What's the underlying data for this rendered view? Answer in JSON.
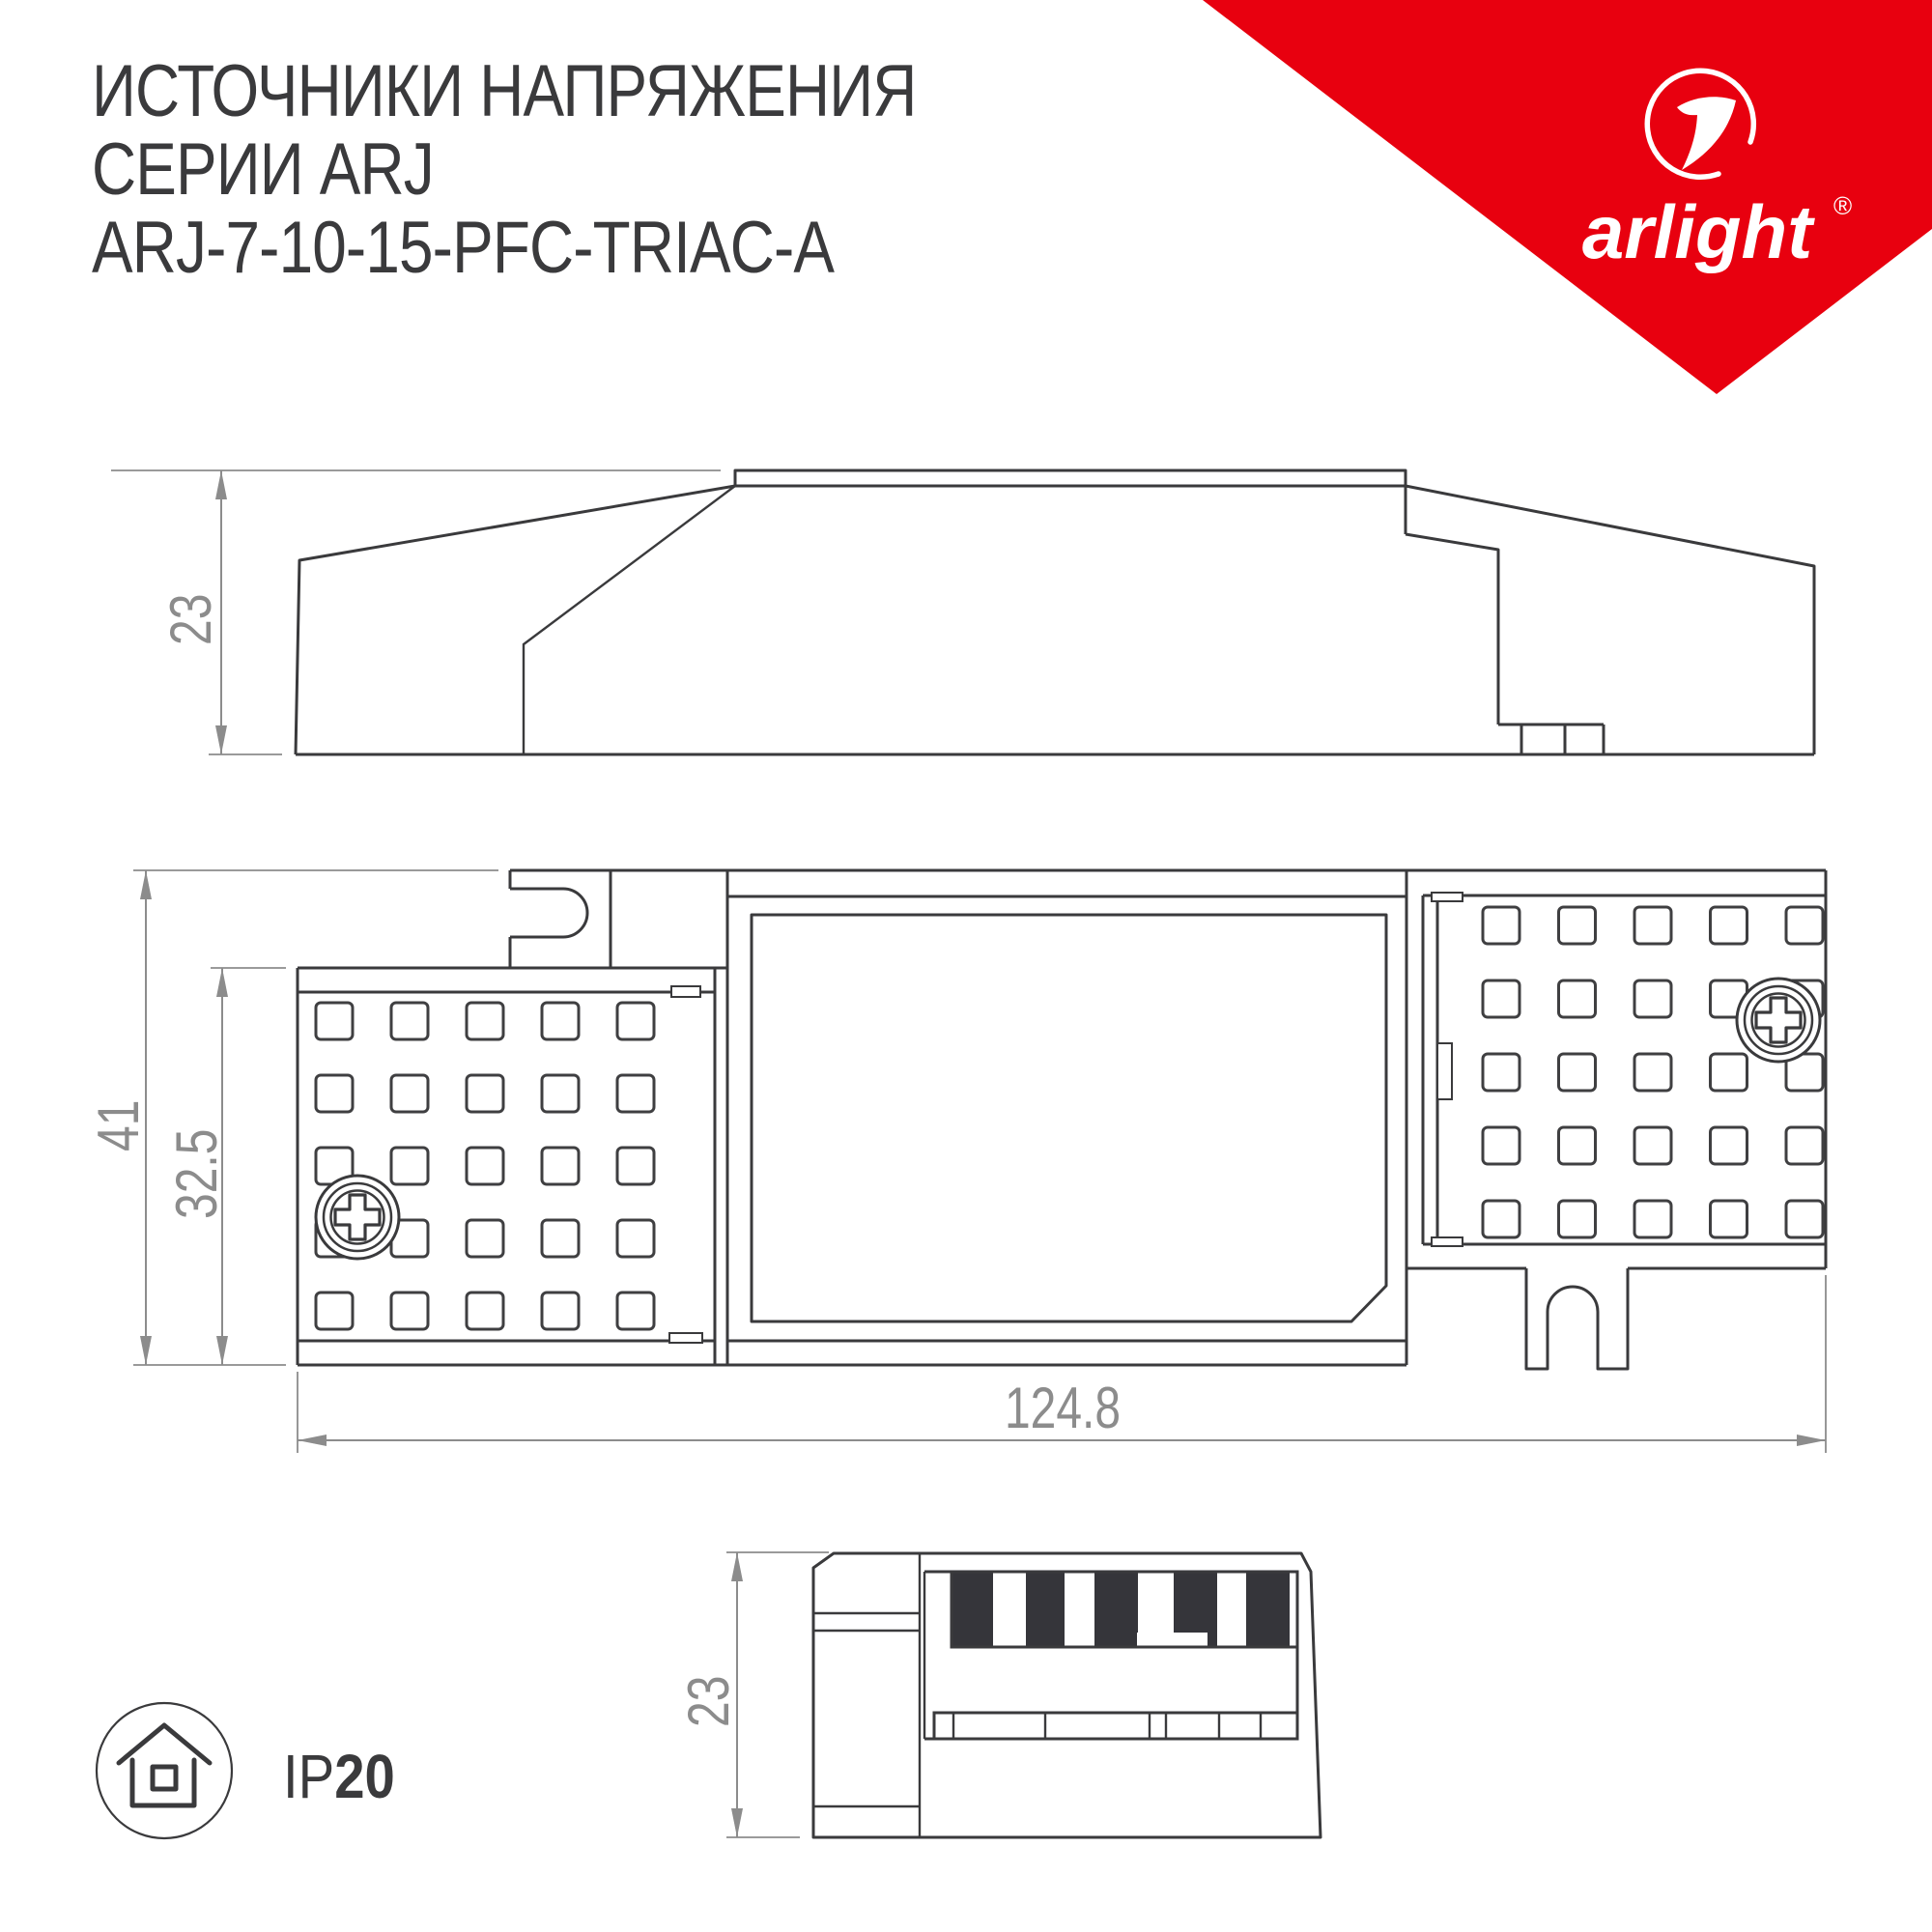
{
  "title": {
    "line1": "ИСТОЧНИКИ НАПРЯЖЕНИЯ",
    "line2": "СЕРИИ ARJ",
    "line3": "ARJ-7-10-15-PFC-TRIAC-A"
  },
  "brand": {
    "name": "arlight",
    "registered": "®",
    "accent_color": "#e8000f"
  },
  "drawings": {
    "side_view": {
      "height_label": "23"
    },
    "plan_view": {
      "total_height_label": "41",
      "body_height_label": "32.5",
      "width_label": "124.8"
    },
    "end_view": {
      "height_label": "23"
    }
  },
  "ip_rating": {
    "prefix": "IP",
    "value": "20",
    "icon": "indoor-use-house-icon"
  },
  "colors": {
    "line": "#3a3a3c",
    "dimension": "#8c8c8c",
    "brand_red": "#e8000f",
    "background": "#ffffff"
  }
}
